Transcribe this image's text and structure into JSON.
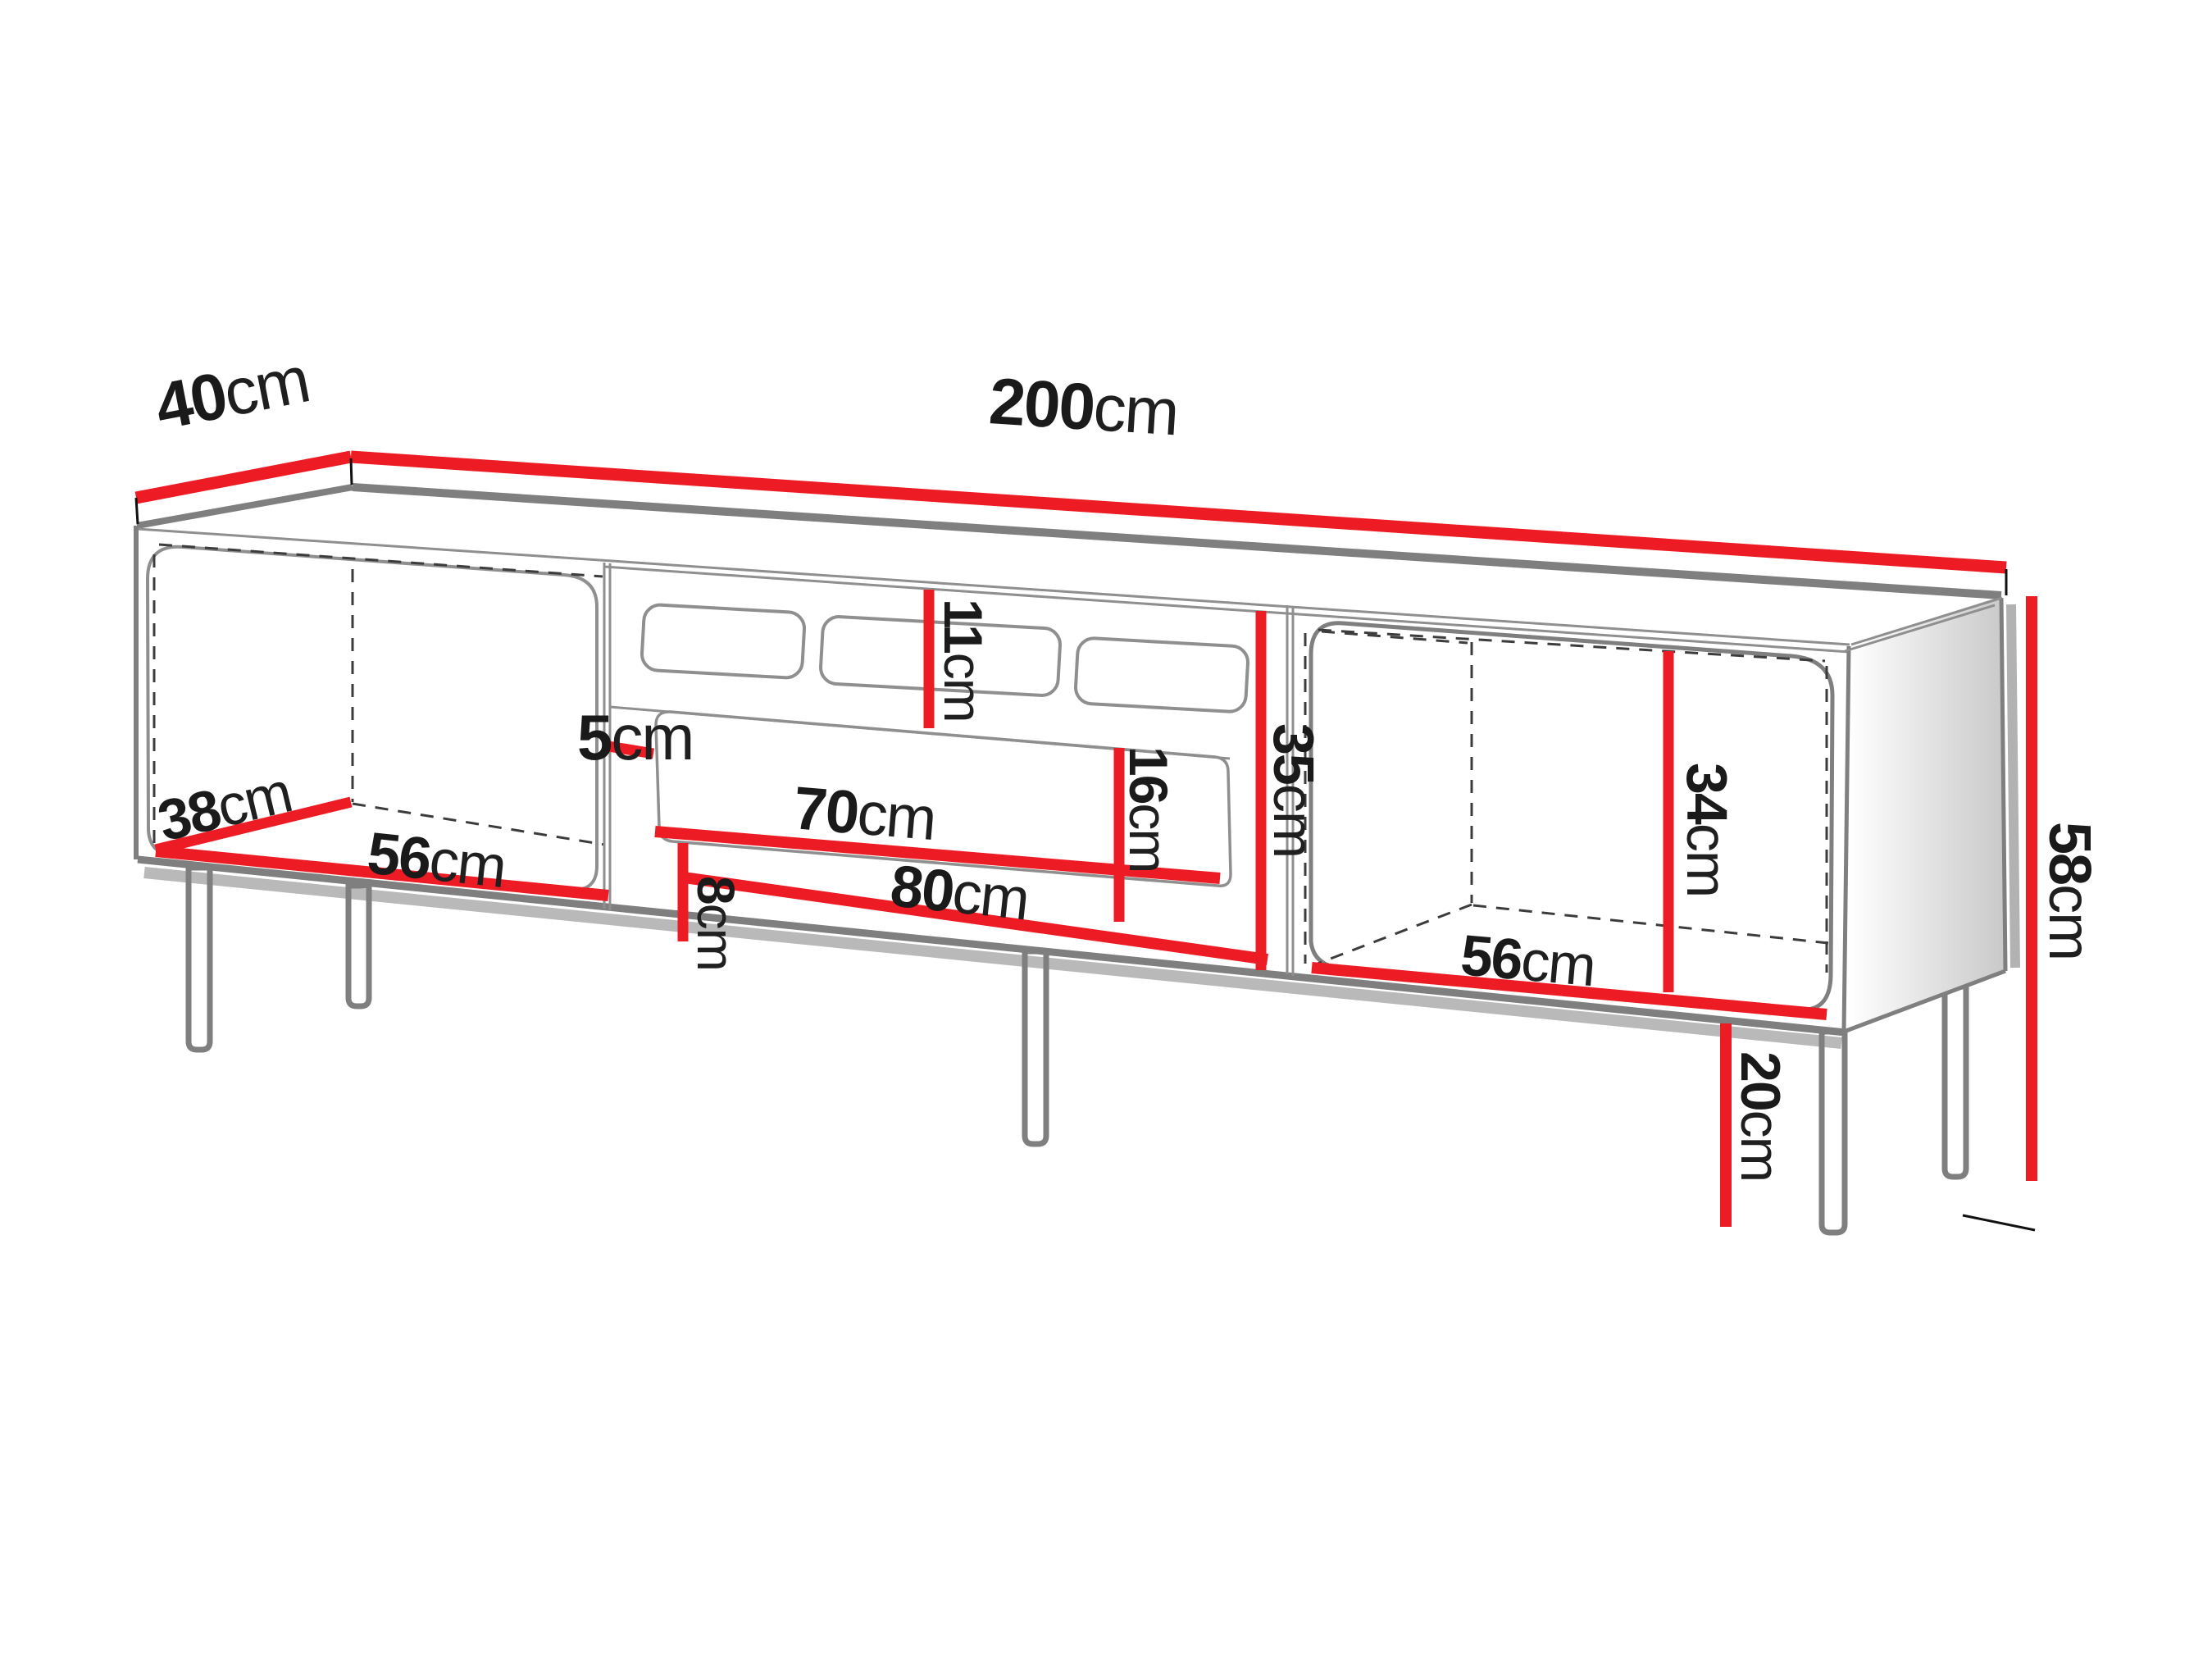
{
  "diagram": {
    "type": "furniture-dimension-diagram",
    "subject": "tv-stand-technical-drawing",
    "unit": "cm",
    "colors": {
      "dimension_line": "#ed1c24",
      "outline_gray": "#7f7f7f",
      "text": "#1a1a1a",
      "background": "#ffffff"
    },
    "dimensions": {
      "top_depth": {
        "value": "40",
        "unit": "cm"
      },
      "total_width": {
        "value": "200",
        "unit": "cm"
      },
      "total_height": {
        "value": "58",
        "unit": "cm"
      },
      "leg_height": {
        "value": "20",
        "unit": "cm"
      },
      "top_niche_height": {
        "value": "11",
        "unit": "cm"
      },
      "middle_section_height": {
        "value": "35",
        "unit": "cm"
      },
      "drawer_front_height": {
        "value": "16",
        "unit": "cm"
      },
      "right_inner_height": {
        "value": "34",
        "unit": "cm"
      },
      "drawer_side_gap": {
        "value": "5",
        "unit": "cm"
      },
      "bottom_gap": {
        "value": "8",
        "unit": "cm"
      },
      "drawer_width": {
        "value": "70",
        "unit": "cm"
      },
      "niche_width": {
        "value": "80",
        "unit": "cm"
      },
      "left_inner_depth": {
        "value": "38",
        "unit": "cm"
      },
      "left_inner_width": {
        "value": "56",
        "unit": "cm"
      },
      "right_inner_width": {
        "value": "56",
        "unit": "cm"
      }
    }
  }
}
